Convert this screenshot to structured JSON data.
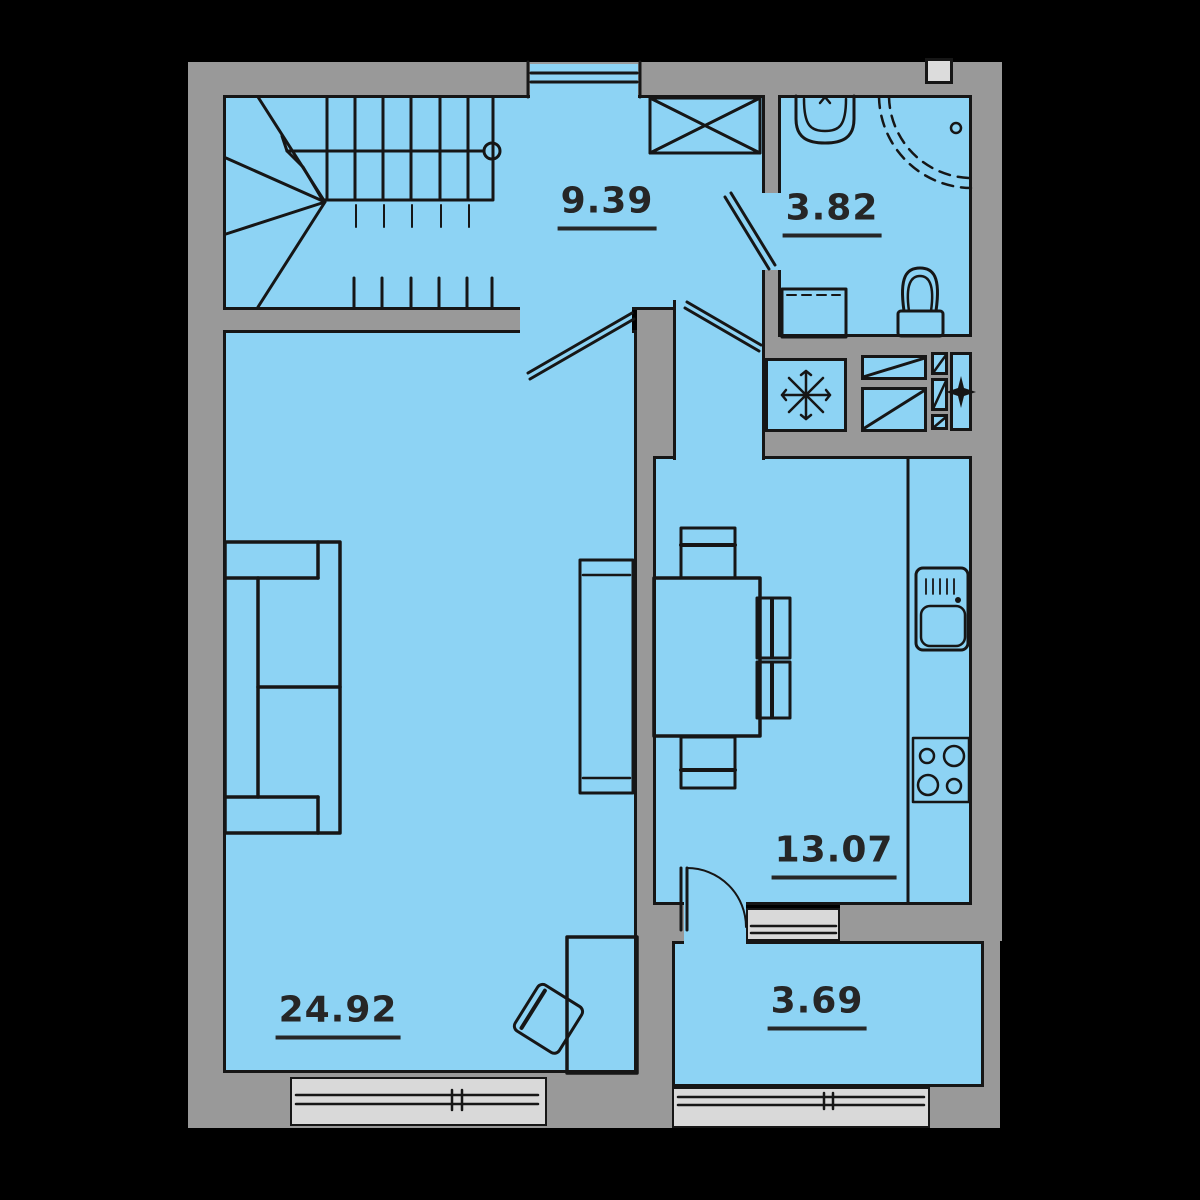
{
  "title": "apartment-floor-plan",
  "colors": {
    "background": "#000000",
    "wall": "#999999",
    "floor": "#8DD3F4",
    "window_sill": "#D9D9D9",
    "line": "#161616",
    "label": "#262626"
  },
  "rooms": [
    {
      "name": "hallway",
      "area": "9.39"
    },
    {
      "name": "bathroom",
      "area": "3.82"
    },
    {
      "name": "kitchen",
      "area": "13.07"
    },
    {
      "name": "living-room",
      "area": "24.92"
    },
    {
      "name": "balcony",
      "area": "3.69"
    }
  ],
  "fixtures": [
    "staircase",
    "stair-direction-line",
    "wardrobe",
    "entrance-door",
    "bathroom-sink",
    "shower",
    "washing-machine",
    "toilet",
    "snowflake-unit",
    "vent-shafts",
    "four-point-star",
    "kitchen-counter",
    "kitchen-sink",
    "stove",
    "dining-table",
    "chairs",
    "sofa",
    "tv-stand",
    "desk",
    "desk-chair",
    "living-room-window",
    "balcony-window",
    "kitchen-balcony-window",
    "balcony-door"
  ]
}
